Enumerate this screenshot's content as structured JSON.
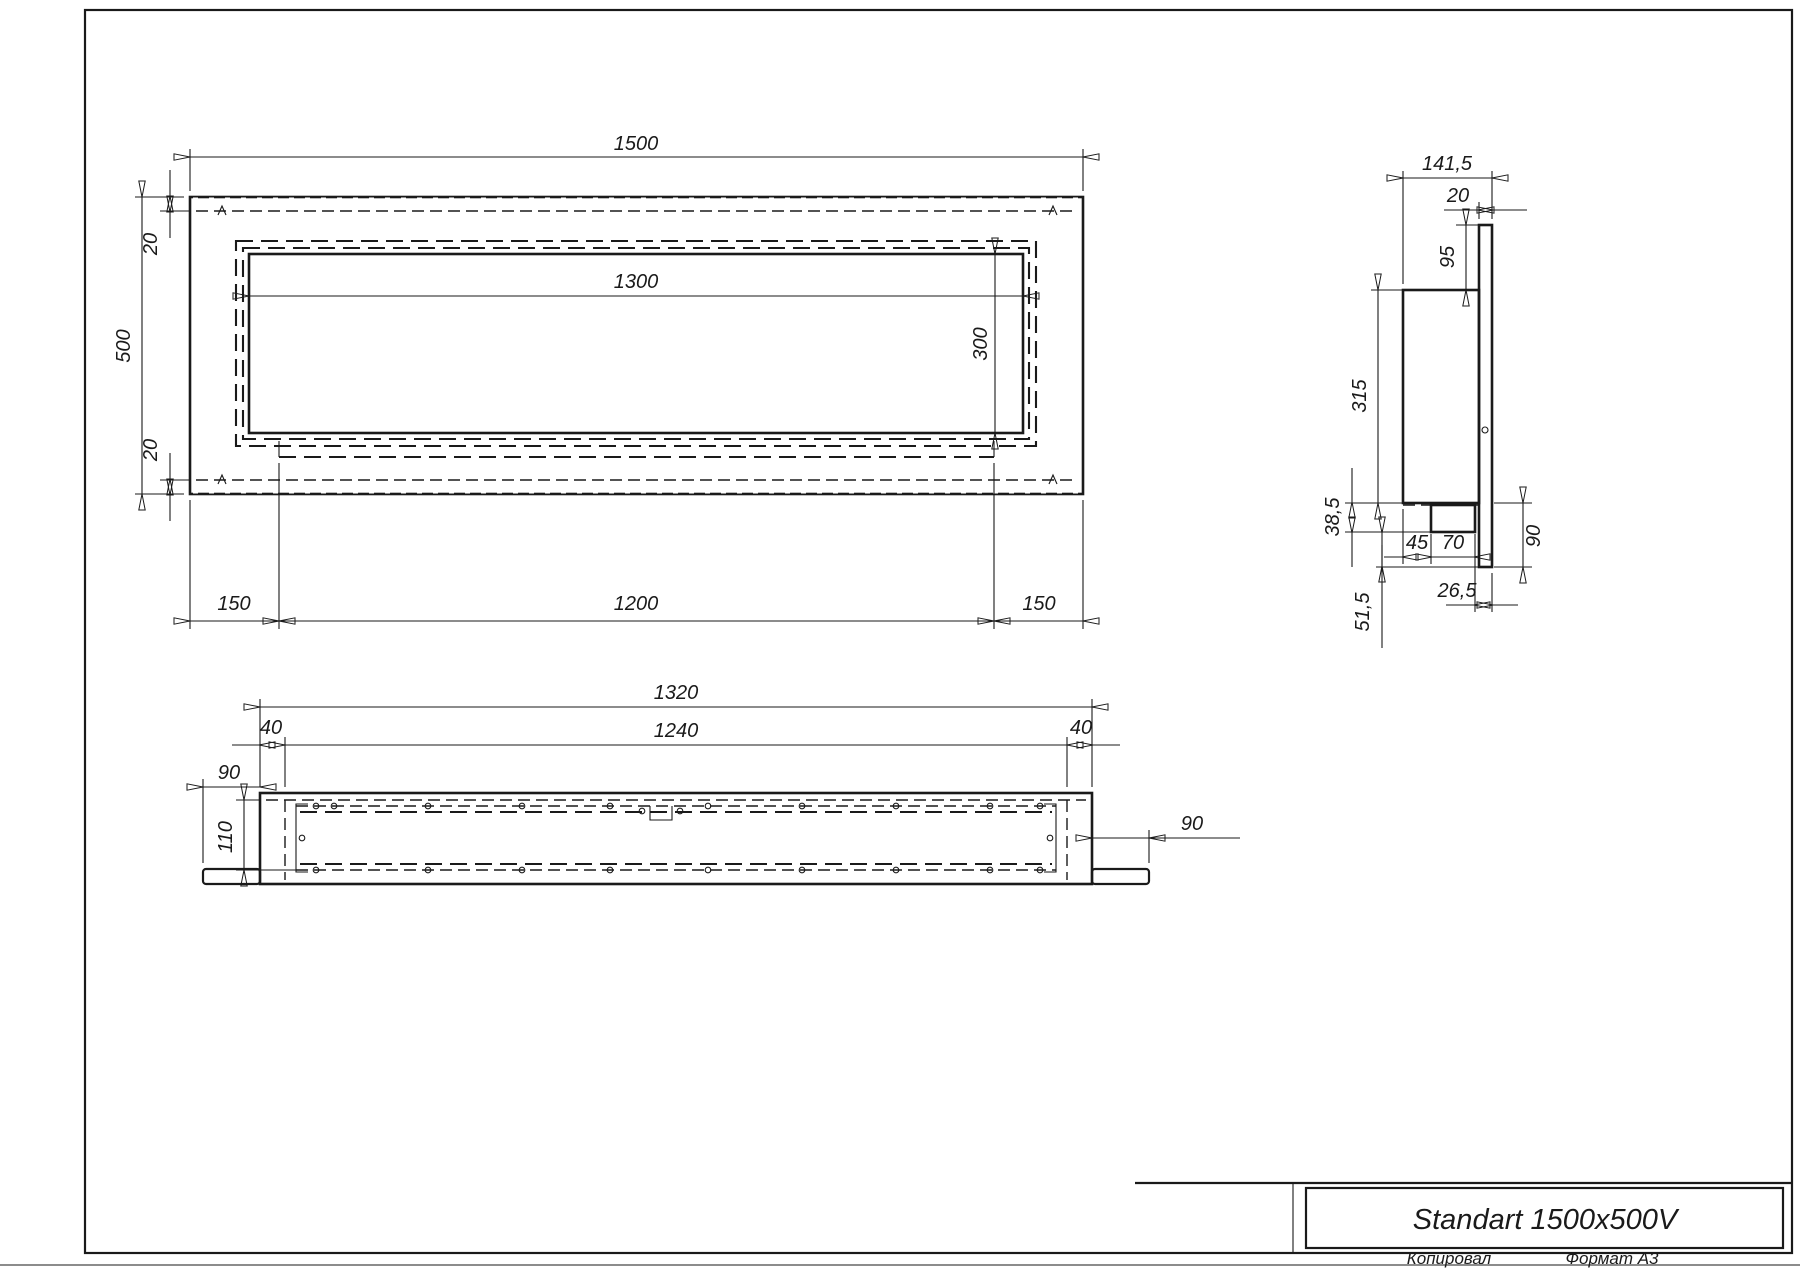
{
  "page": {
    "copied_label": "Копировал",
    "format_label": "Формат А3"
  },
  "title_block": {
    "model": "Standart 1500x500V"
  },
  "front_view": {
    "width": "1500",
    "height": "500",
    "flange_top": "20",
    "flange_bottom": "20",
    "opening_width": "1300",
    "opening_height": "300",
    "offset_left": "150",
    "insert_width": "1200",
    "offset_right": "150"
  },
  "side_view": {
    "depth": "141,5",
    "front_plate": "20",
    "top_gap": "95",
    "body_height": "315",
    "shelf_height": "38,5",
    "fuel_offset": "45",
    "fuel_width": "70",
    "plate_bottom": "90",
    "back_offset": "26,5",
    "drop": "51,5"
  },
  "bottom_view": {
    "box_width": "1320",
    "inner_width": "1240",
    "wall_left": "40",
    "wall_right": "40",
    "flange_left": "90",
    "flange_right": "90",
    "inner_depth": "110"
  }
}
